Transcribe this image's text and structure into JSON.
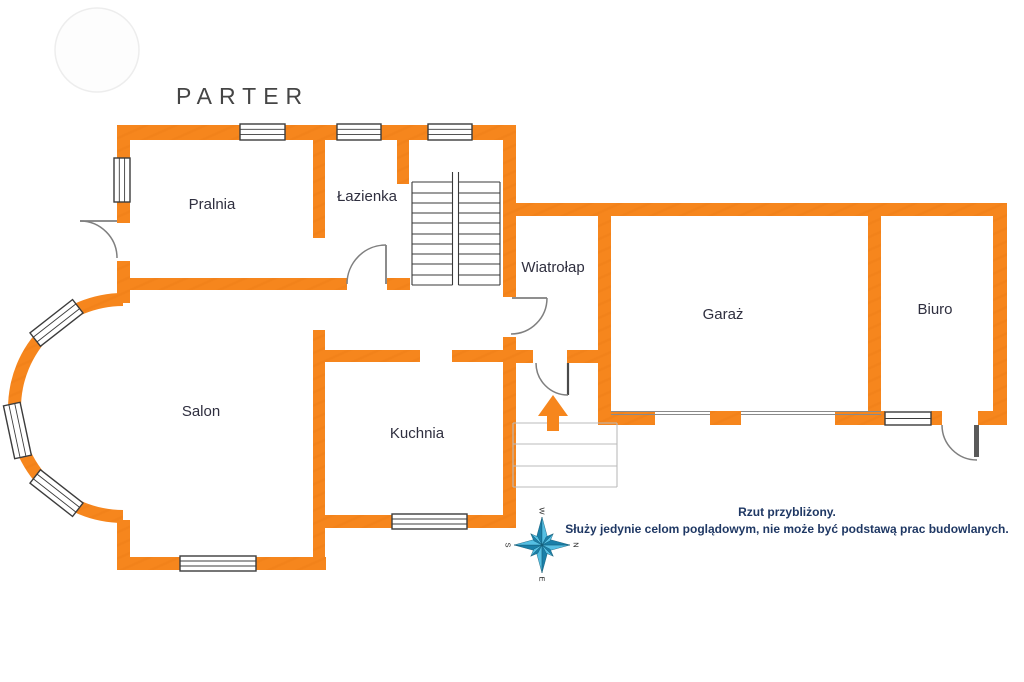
{
  "title": "PARTER",
  "rooms": {
    "pralnia": "Pralnia",
    "lazienka": "Łazienka",
    "wiatrolap": "Wiatrołap",
    "garaz": "Garaż",
    "biuro": "Biuro",
    "salon": "Salon",
    "kuchnia": "Kuchnia"
  },
  "compass": {
    "n": "N",
    "e": "E",
    "s": "S",
    "w": "W"
  },
  "disclaimer": {
    "line1": "Rzut przybliżony.",
    "line2": "Służy jedynie celom poglądowym, nie może być podstawą prac budowlanych."
  },
  "colors": {
    "wall": "#F6861D",
    "door_arc": "#7F7F7F",
    "window_frame": "#3C3C3C",
    "stairs": "#3A3A3A",
    "steps": "#BBBBBB",
    "compass_dark": "#1A7FA8",
    "compass_light": "#55BFE3",
    "label": "#2F2F3F",
    "note": "#1F3864"
  }
}
